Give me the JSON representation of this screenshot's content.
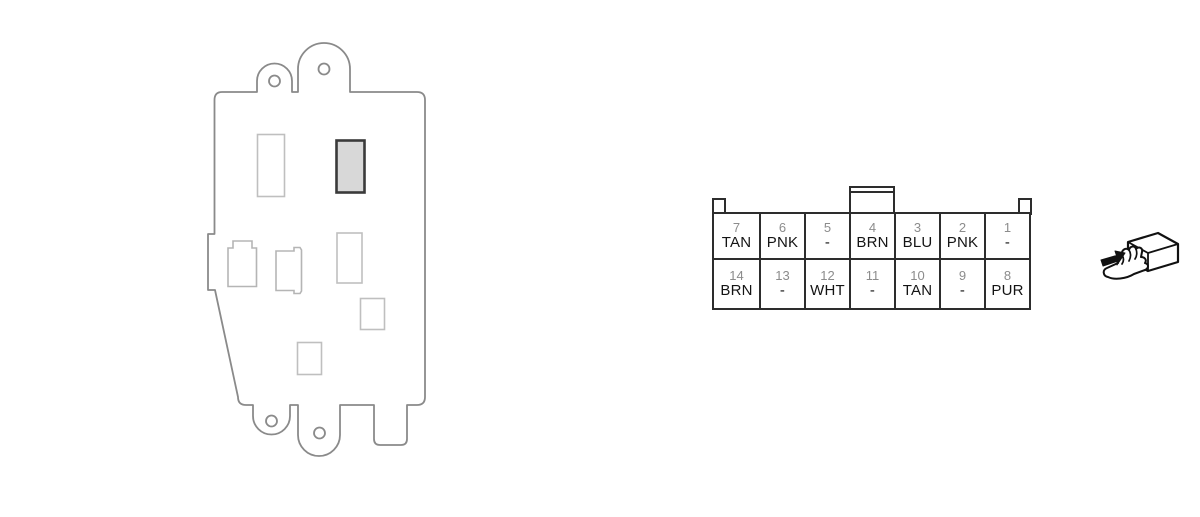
{
  "module": {
    "description": "fuse-relay-module-rear-view",
    "outline_color": "#8a8a8a",
    "detail_color": "#bfbfbf",
    "highlight_fill": "#d8d8d8",
    "highlight_border": "#3a3a3a"
  },
  "connector": {
    "description": "14-pin-connector-face-view",
    "border_color": "#2d2d2d",
    "pin_number_color": "#8c8c8c",
    "wire_label_color": "#141414",
    "rows": [
      {
        "cells": [
          {
            "pin": "7",
            "wire": "TAN"
          },
          {
            "pin": "6",
            "wire": "PNK"
          },
          {
            "pin": "5",
            "wire": "-"
          },
          {
            "pin": "4",
            "wire": "BRN"
          },
          {
            "pin": "3",
            "wire": "BLU"
          },
          {
            "pin": "2",
            "wire": "PNK"
          },
          {
            "pin": "1",
            "wire": "-"
          }
        ]
      },
      {
        "cells": [
          {
            "pin": "14",
            "wire": "BRN"
          },
          {
            "pin": "13",
            "wire": "-"
          },
          {
            "pin": "12",
            "wire": "WHT"
          },
          {
            "pin": "11",
            "wire": "-"
          },
          {
            "pin": "10",
            "wire": "TAN"
          },
          {
            "pin": "9",
            "wire": "-"
          },
          {
            "pin": "8",
            "wire": "PUR"
          }
        ]
      }
    ]
  },
  "hand_icon": {
    "name": "hand-holding-connector-icon",
    "color": "#111111"
  }
}
